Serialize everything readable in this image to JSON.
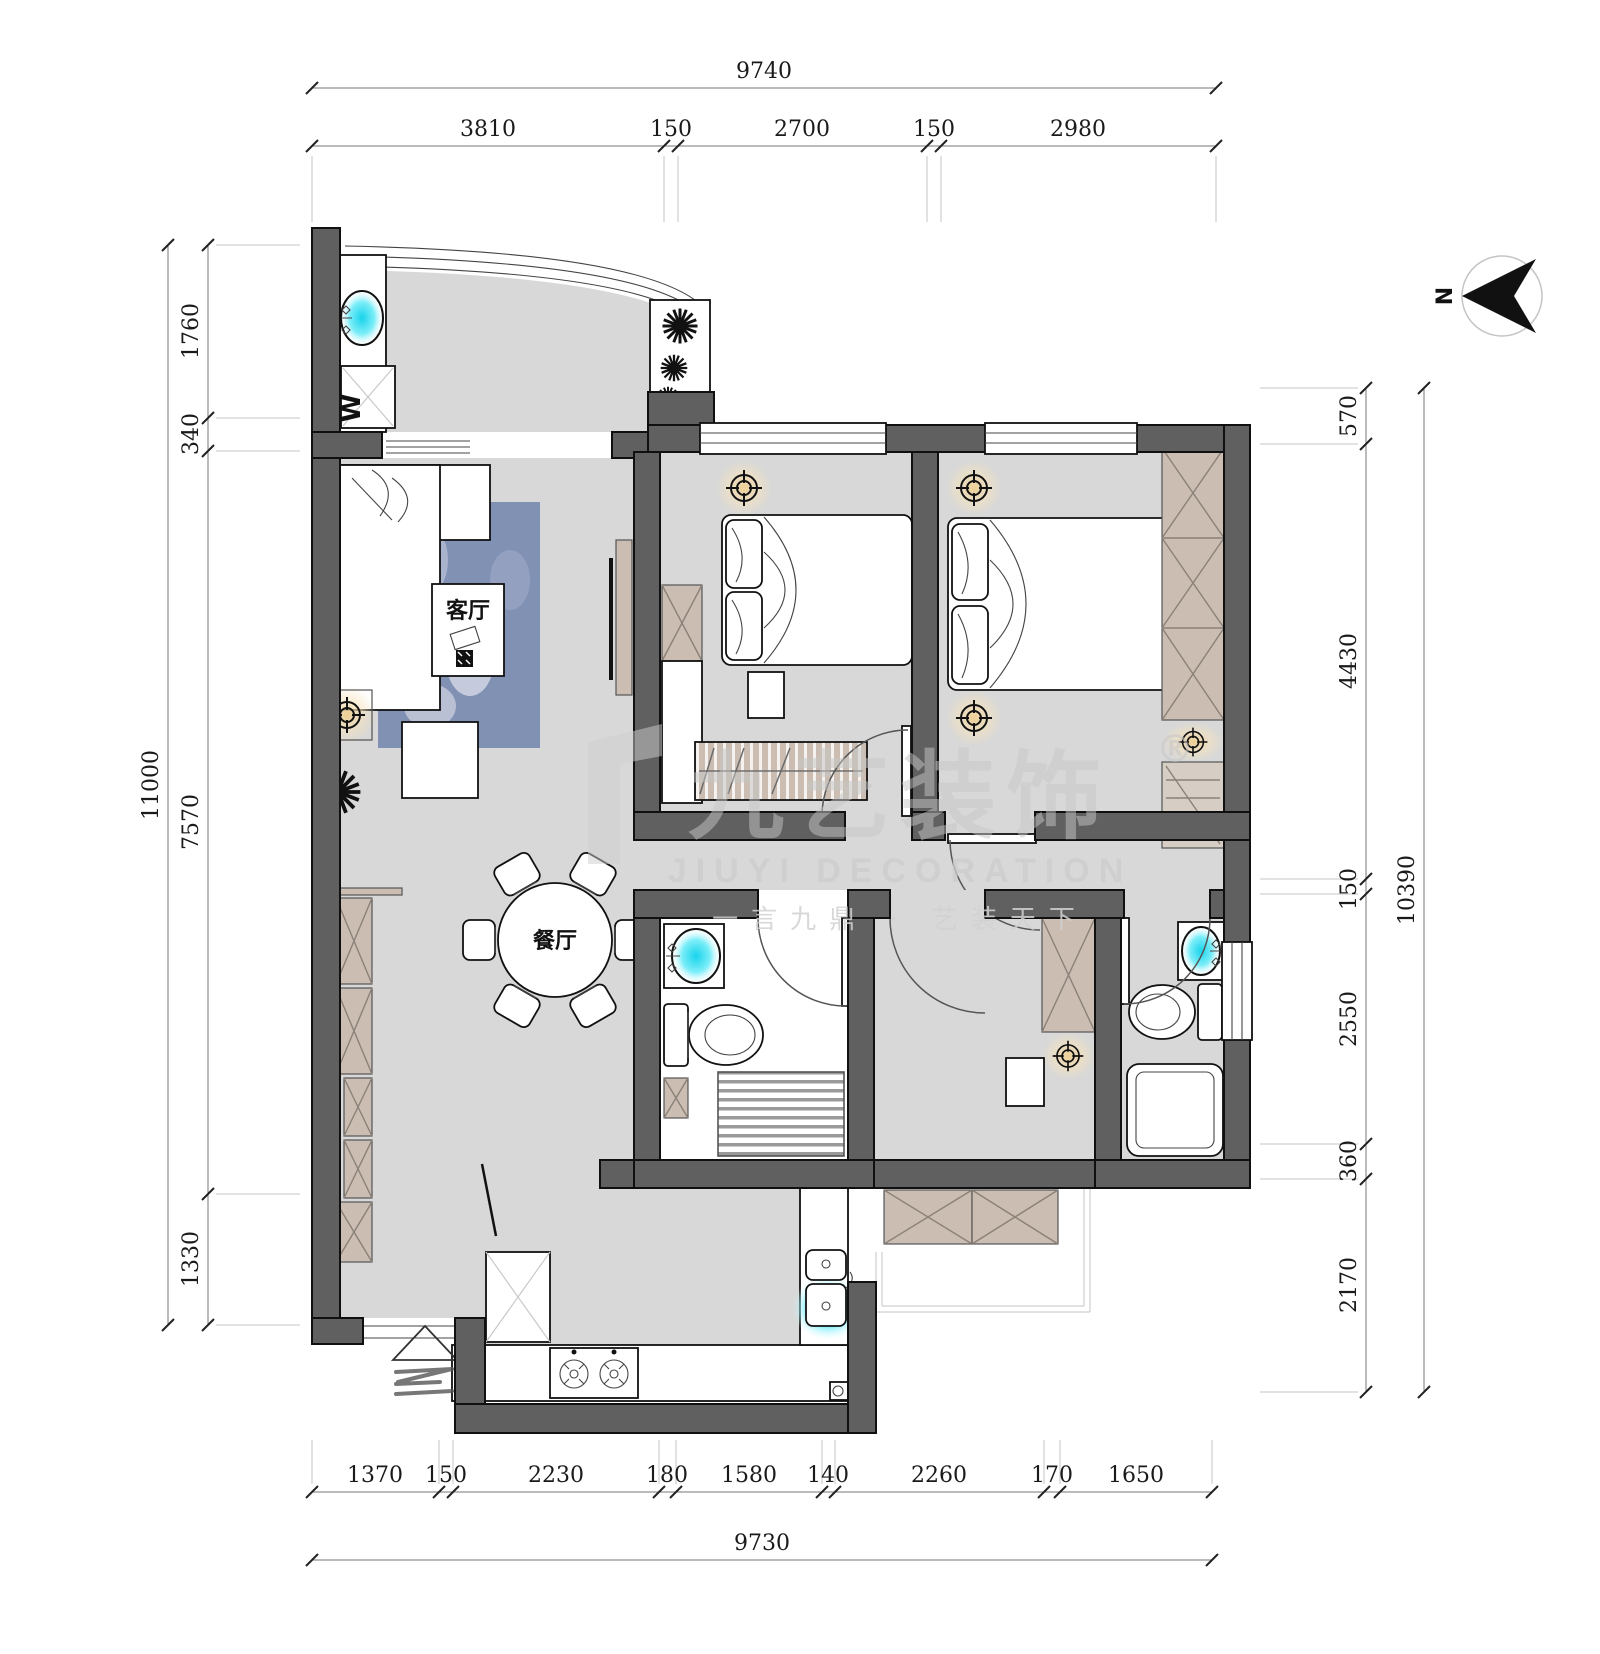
{
  "dimensions": {
    "top": {
      "total": "9740",
      "segments": [
        "3810",
        "150",
        "2700",
        "150",
        "2980"
      ]
    },
    "bottom": {
      "total": "9730",
      "segments": [
        "1370",
        "150",
        "2230",
        "180",
        "1580",
        "140",
        "2260",
        "170",
        "1650"
      ]
    },
    "left": {
      "total": "11000",
      "segments": [
        "1760",
        "340",
        "7570",
        "1330"
      ]
    },
    "right": {
      "total": "10390",
      "segments": [
        "570",
        "4430",
        "150",
        "2550",
        "360",
        "2170"
      ]
    }
  },
  "rooms": {
    "living": "客厅",
    "dining": "餐厅"
  },
  "appliances": {
    "washer": "W"
  },
  "compass": {
    "north": "N"
  },
  "watermark": {
    "brand_cn": "九艺装饰",
    "registered": "®",
    "brand_en": "JIUYI DECORATION",
    "tagline": "一言九鼎 · 艺装天下"
  },
  "colors": {
    "wall": "#606060",
    "floor": "#d8d8d8",
    "cabinet": "#cbbdb2",
    "water": "#2fd9ee",
    "glow": "#f2d9a8",
    "rug": "#8091b4",
    "watermark": "#c9c9c9"
  }
}
